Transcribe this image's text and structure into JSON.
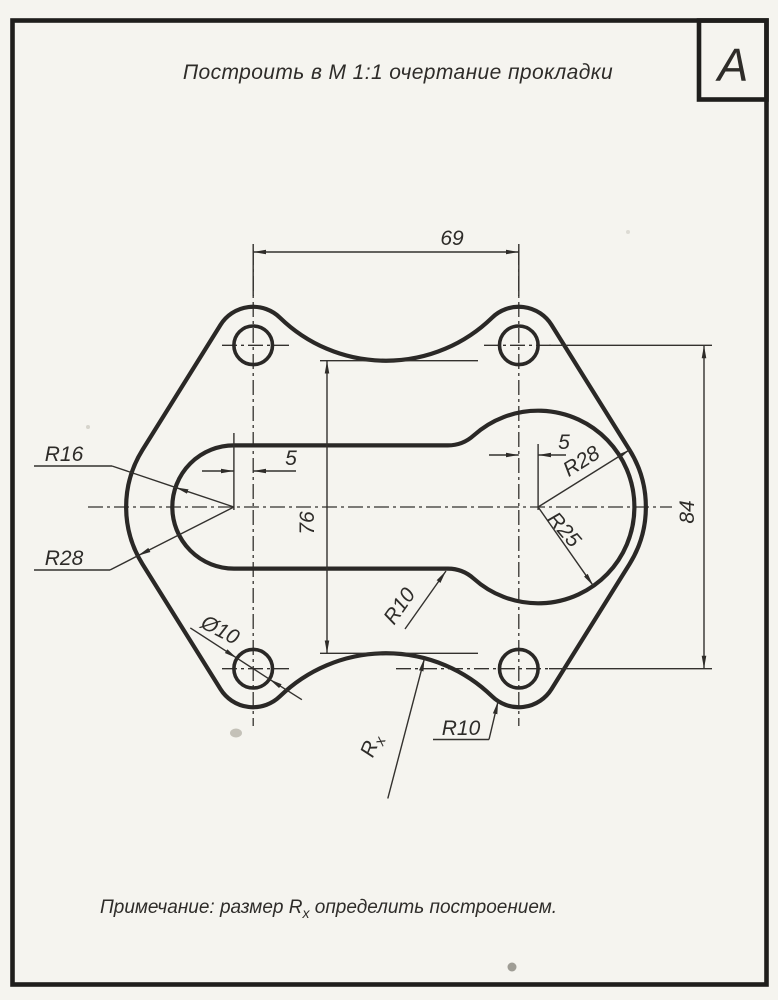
{
  "page": {
    "background": "#f5f4ef",
    "ink": "#2e2c29"
  },
  "header": {
    "title": "Построить в М 1:1 очертание прокладки",
    "corner_letter": "А"
  },
  "labels": {
    "dim_hole_span_horizontal": "69",
    "dim_hole_span_vertical": "84",
    "dim_arc_span_vertical": "76",
    "dim_offset_left": "5",
    "dim_offset_right": "5",
    "r_slot_left_end": "R16",
    "r_outer_left": "R28",
    "r_outer_right": "R28",
    "r_slot_right_circle": "R25",
    "r_slot_fillet": "R10",
    "r_hole_corner": "R10",
    "dia_bolt_hole": "Ø10",
    "r_unknown_base": "R",
    "r_unknown_sub": "x"
  },
  "note": {
    "prefix": "Примечание: размер R",
    "sub": "x",
    "suffix": " определить построением."
  }
}
